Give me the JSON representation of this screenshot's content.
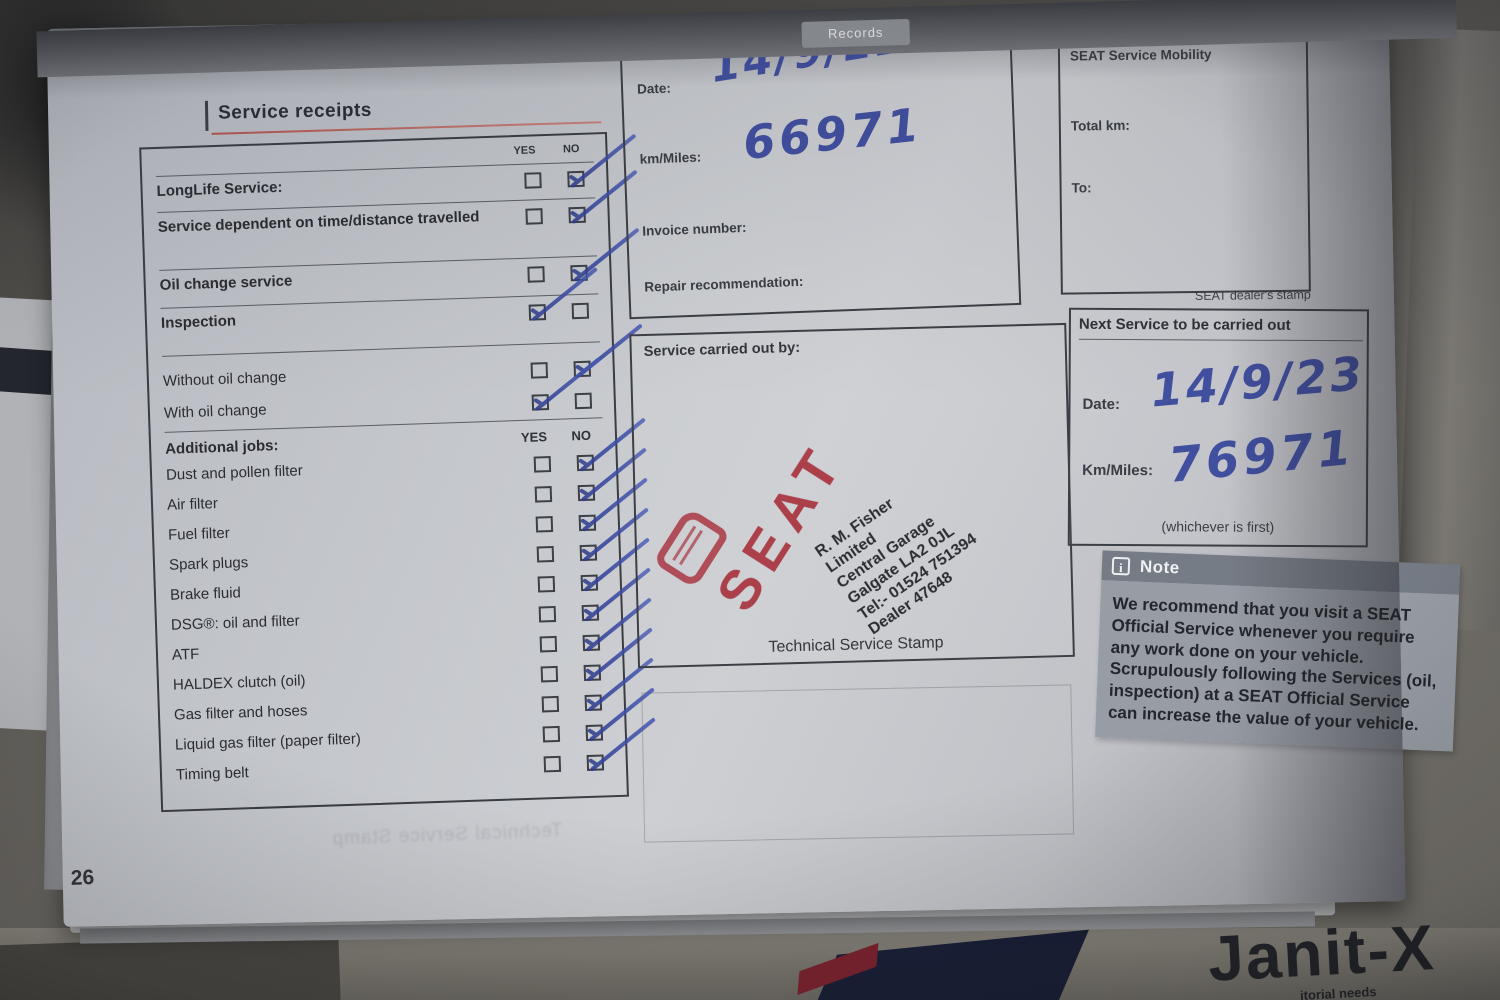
{
  "page": {
    "tab_label": "Records",
    "title": "Service receipts",
    "page_number": "26"
  },
  "checklist": {
    "yes_header": "YES",
    "no_header": "NO",
    "main_rows": [
      {
        "label": "LongLife Service:",
        "yes": false,
        "no": true
      },
      {
        "label": "Service dependent on time/distance travelled",
        "yes": false,
        "no": true
      },
      {
        "label": "Oil change service",
        "yes": false,
        "no": true
      },
      {
        "label": "Inspection",
        "yes": true,
        "no": false
      },
      {
        "label": "Without oil change",
        "yes": false,
        "no": true
      },
      {
        "label": "With oil change",
        "yes": true,
        "no": false
      }
    ],
    "additional_header": "Additional jobs:",
    "additional_rows": [
      {
        "label": "Dust and pollen filter",
        "yes": false,
        "no": true
      },
      {
        "label": "Air filter",
        "yes": false,
        "no": true
      },
      {
        "label": "Fuel filter",
        "yes": false,
        "no": true
      },
      {
        "label": "Spark plugs",
        "yes": false,
        "no": true
      },
      {
        "label": "Brake fluid",
        "yes": false,
        "no": true
      },
      {
        "label": "DSG®: oil and filter",
        "yes": false,
        "no": true
      },
      {
        "label": "ATF",
        "yes": false,
        "no": true
      },
      {
        "label": "HALDEX clutch (oil)",
        "yes": false,
        "no": true
      },
      {
        "label": "Gas filter and hoses",
        "yes": false,
        "no": true
      },
      {
        "label": "Liquid gas filter (paper filter)",
        "yes": false,
        "no": true
      },
      {
        "label": "Timing belt",
        "yes": false,
        "no": true
      }
    ]
  },
  "service_record": {
    "date_label": "Date:",
    "date_value": "14/9/22",
    "km_label": "km/Miles:",
    "km_value": "66971",
    "invoice_label": "Invoice number:",
    "repair_label": "Repair recommendation:",
    "carried_out_label": "Service carried out by:",
    "stamp_lines": [
      "R. M. Fisher",
      "Limited",
      "Central Garage",
      "Galgate  LA2 0JL",
      "Tel:- 01524 751394",
      "Dealer 47648"
    ],
    "seat_stamp_text": "SEAT",
    "stamp_caption": "Technical Service Stamp"
  },
  "mobility": {
    "title": "SEAT Service Mobility",
    "total_km_label": "Total km:",
    "to_label": "To:",
    "dealer_stamp_label": "SEAT dealer's stamp"
  },
  "next_service": {
    "title": "Next Service to be carried out",
    "date_label": "Date:",
    "date_value": "14/9/23",
    "km_label": "Km/Miles:",
    "km_value": "76971",
    "whichever": "(whichever is first)"
  },
  "note_box": {
    "title": "Note",
    "info_glyph": "i",
    "body": "We recommend that you visit a SEAT Official Service whenever you require any work done on your vehicle. Scrupulously following the Services (oil, inspection) at a SEAT Official Service can increase the value of your vehicle."
  },
  "background": {
    "ghost_caption": "Technical Service Stamp",
    "calendar_header": "W",
    "calendar_values": [
      "5",
      "12",
      "19",
      "26"
    ],
    "desk_brand": "Janit-X",
    "desk_brand_sub": "itorial needs"
  },
  "colors": {
    "ink_blue": "#36459c",
    "stamp_red": "#a31c28",
    "paper": "#c9cbd0",
    "accent_underline": "#b2564f"
  }
}
